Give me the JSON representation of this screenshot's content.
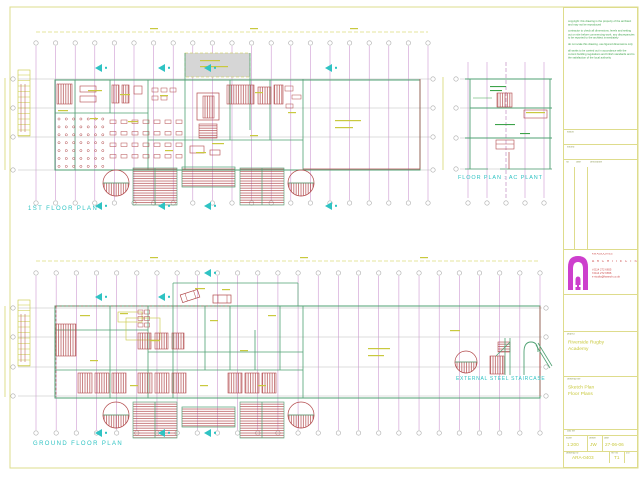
{
  "sheet": {
    "plan_titles": {
      "first_floor": "1ST   FLOOR  PLAN",
      "ground_floor": "GROUND  FLOOR  PLAN",
      "ac_plant": "FLOOR  PLAN : AC  PLANT",
      "staircase": "EXTERNAL  STEEL  STAIRCASE"
    }
  },
  "colors": {
    "grid": "#c98fcd",
    "bubble": "#aaaaaa",
    "wall": "#4fa173",
    "detail_red": "#b24a4c",
    "annotation_yellow": "#c9c93e",
    "marker_cyan": "#2fc3c3",
    "notes_green": "#3da34a",
    "border_yellow": "#dedc8c",
    "logo_magenta": "#cd3fcd",
    "company_red": "#cc4747",
    "roof_gray": "#d6d6d6"
  },
  "title_block": {
    "notes": [
      "copyright: this drawing is the property of the architect and may not be reproduced",
      "contractor to check all dimensions, levels and setting out on site before commencing work. any discrepancies to be reported to the architect immediately",
      "do not scale this drawing. use figured dimensions only",
      "all works to be carried out in accordance with the current building regulations and british standards and to the satisfaction of the local authority"
    ],
    "section_labels": {
      "status": "status",
      "issued": "issued",
      "cad": "cad file"
    },
    "revision_table": {
      "col_no": "no",
      "col_date": "date",
      "col_description": "description"
    },
    "company": {
      "name": "KW ASSOCIATES",
      "title": "A R C H I T E C T S",
      "contact1": "t 0114 272 6655",
      "contact2": "f 0114 272 6656",
      "contact3": "e studio@kwarch.co.uk"
    },
    "project": {
      "label": "project",
      "line1": "Riverside Rugby",
      "line2": "Academy"
    },
    "drawing": {
      "label": "drawing title",
      "line1": "Sketch Plan",
      "line2": "Floor Plans"
    },
    "fields": {
      "scale_label": "scale",
      "scale_value": "1:200",
      "drawn_label": "drawn",
      "drawn_value": "JW",
      "date_label": "date",
      "date_value": "27-06-06",
      "dno_label": "drawing no",
      "dno_value": "ARA-0403",
      "rev_label": "rev no",
      "rev_value": "T1",
      "extra_label": "c/o"
    }
  }
}
